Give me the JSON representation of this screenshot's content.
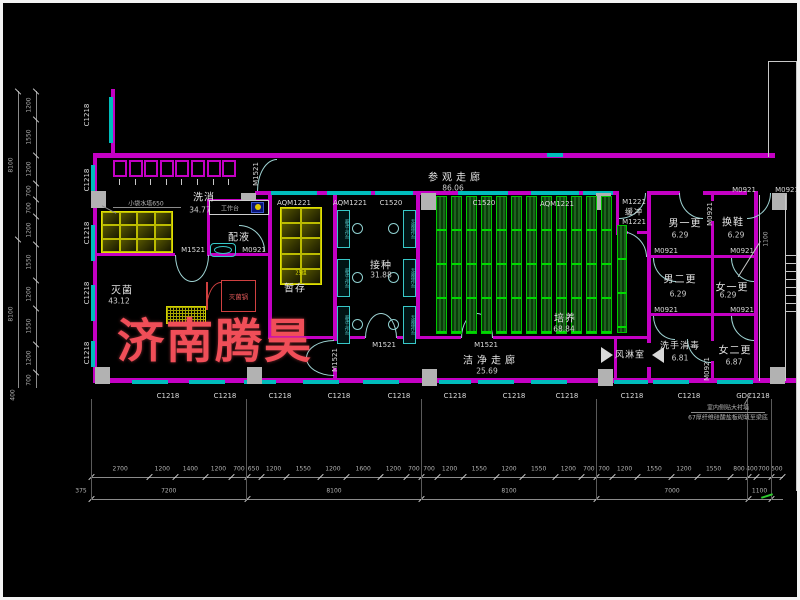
{
  "watermark": {
    "text": "济南腾昊",
    "color": "#f04e58"
  },
  "rooms": [
    {
      "id": "xixiao",
      "name": "洗消",
      "area": "34.77"
    },
    {
      "id": "peiye",
      "name": "配液",
      "area": ""
    },
    {
      "id": "miejun",
      "name": "灭菌",
      "area": "43.12"
    },
    {
      "id": "zancun",
      "name": "暂存",
      "area": ""
    },
    {
      "id": "jiezhong",
      "name": "接种",
      "area": "31.88"
    },
    {
      "id": "peiyang",
      "name": "培养",
      "area": "68.84"
    },
    {
      "id": "canguan",
      "name": "参观走廊",
      "area": "86.06"
    },
    {
      "id": "jiejing",
      "name": "洁净走廊",
      "area": "25.69"
    },
    {
      "id": "fenglin",
      "name": "风淋室",
      "area": ""
    },
    {
      "id": "huanchong",
      "name": "缓冲",
      "area": ""
    },
    {
      "id": "nanyigeng",
      "name": "男一更",
      "area": "6.29"
    },
    {
      "id": "huanxie",
      "name": "换鞋",
      "area": "6.29"
    },
    {
      "id": "nanergeng",
      "name": "男二更",
      "area": "6.29"
    },
    {
      "id": "nvyigeng",
      "name": "女一更",
      "area": "6.29"
    },
    {
      "id": "xishou",
      "name": "洗手消毒",
      "area": "6.81"
    },
    {
      "id": "nvergeng",
      "name": "女二更",
      "area": "6.87"
    }
  ],
  "door_codes": [
    "M1521",
    "M1521",
    "M0921",
    "M1221",
    "M1221",
    "M0921",
    "M0921",
    "M0921",
    "M0921",
    "M0921",
    "M0921",
    "M0921",
    "M0921",
    "M1521",
    "M1521",
    "M1521"
  ],
  "window_codes_top": [
    "AQM1221",
    "AQM1221",
    "C1520",
    "C1520",
    "AQM1221"
  ],
  "window_codes_bottom": [
    "C1218",
    "C1218",
    "C1218",
    "C1218",
    "C1218",
    "C1218",
    "C1218",
    "C1218",
    "C1218",
    "C1218",
    "GDC1218"
  ],
  "window_codes_left": [
    "C1218",
    "C1218",
    "C1218",
    "C1218",
    "C1218"
  ],
  "equipment": {
    "worktable": "工作台",
    "autoclave": "灭菌锅",
    "shelf_count": "25组",
    "sink_note": "小袋水塔650",
    "bench_left": "超净工作台",
    "bench_right": "无菌操作台"
  },
  "notes": {
    "line1": "室内侧贴大衬墙",
    "line2": "67厚纤维硅酸盐板砌筑至梁底"
  },
  "dimensions": {
    "bottom_detail": [
      "2700",
      "1200",
      "1400",
      "1200",
      "700",
      "650",
      "1200",
      "1550",
      "1200",
      "1600",
      "1200",
      "700",
      "700",
      "1200",
      "1550",
      "1200",
      "1550",
      "1200",
      "700",
      "700",
      "1200",
      "1550",
      "1200",
      "1550",
      "800",
      "400",
      "700",
      "500"
    ],
    "bottom_overall": [
      "7200",
      "8100",
      "8100",
      "7000",
      "1100"
    ],
    "offset_left": "375",
    "left_detail": [
      "1200",
      "1550",
      "1200",
      "700",
      "700",
      "1200",
      "1550",
      "1200",
      "1550",
      "1200",
      "700"
    ],
    "left_overall": [
      "8100",
      "8100"
    ],
    "corner": "400",
    "stair_width": "1100"
  }
}
